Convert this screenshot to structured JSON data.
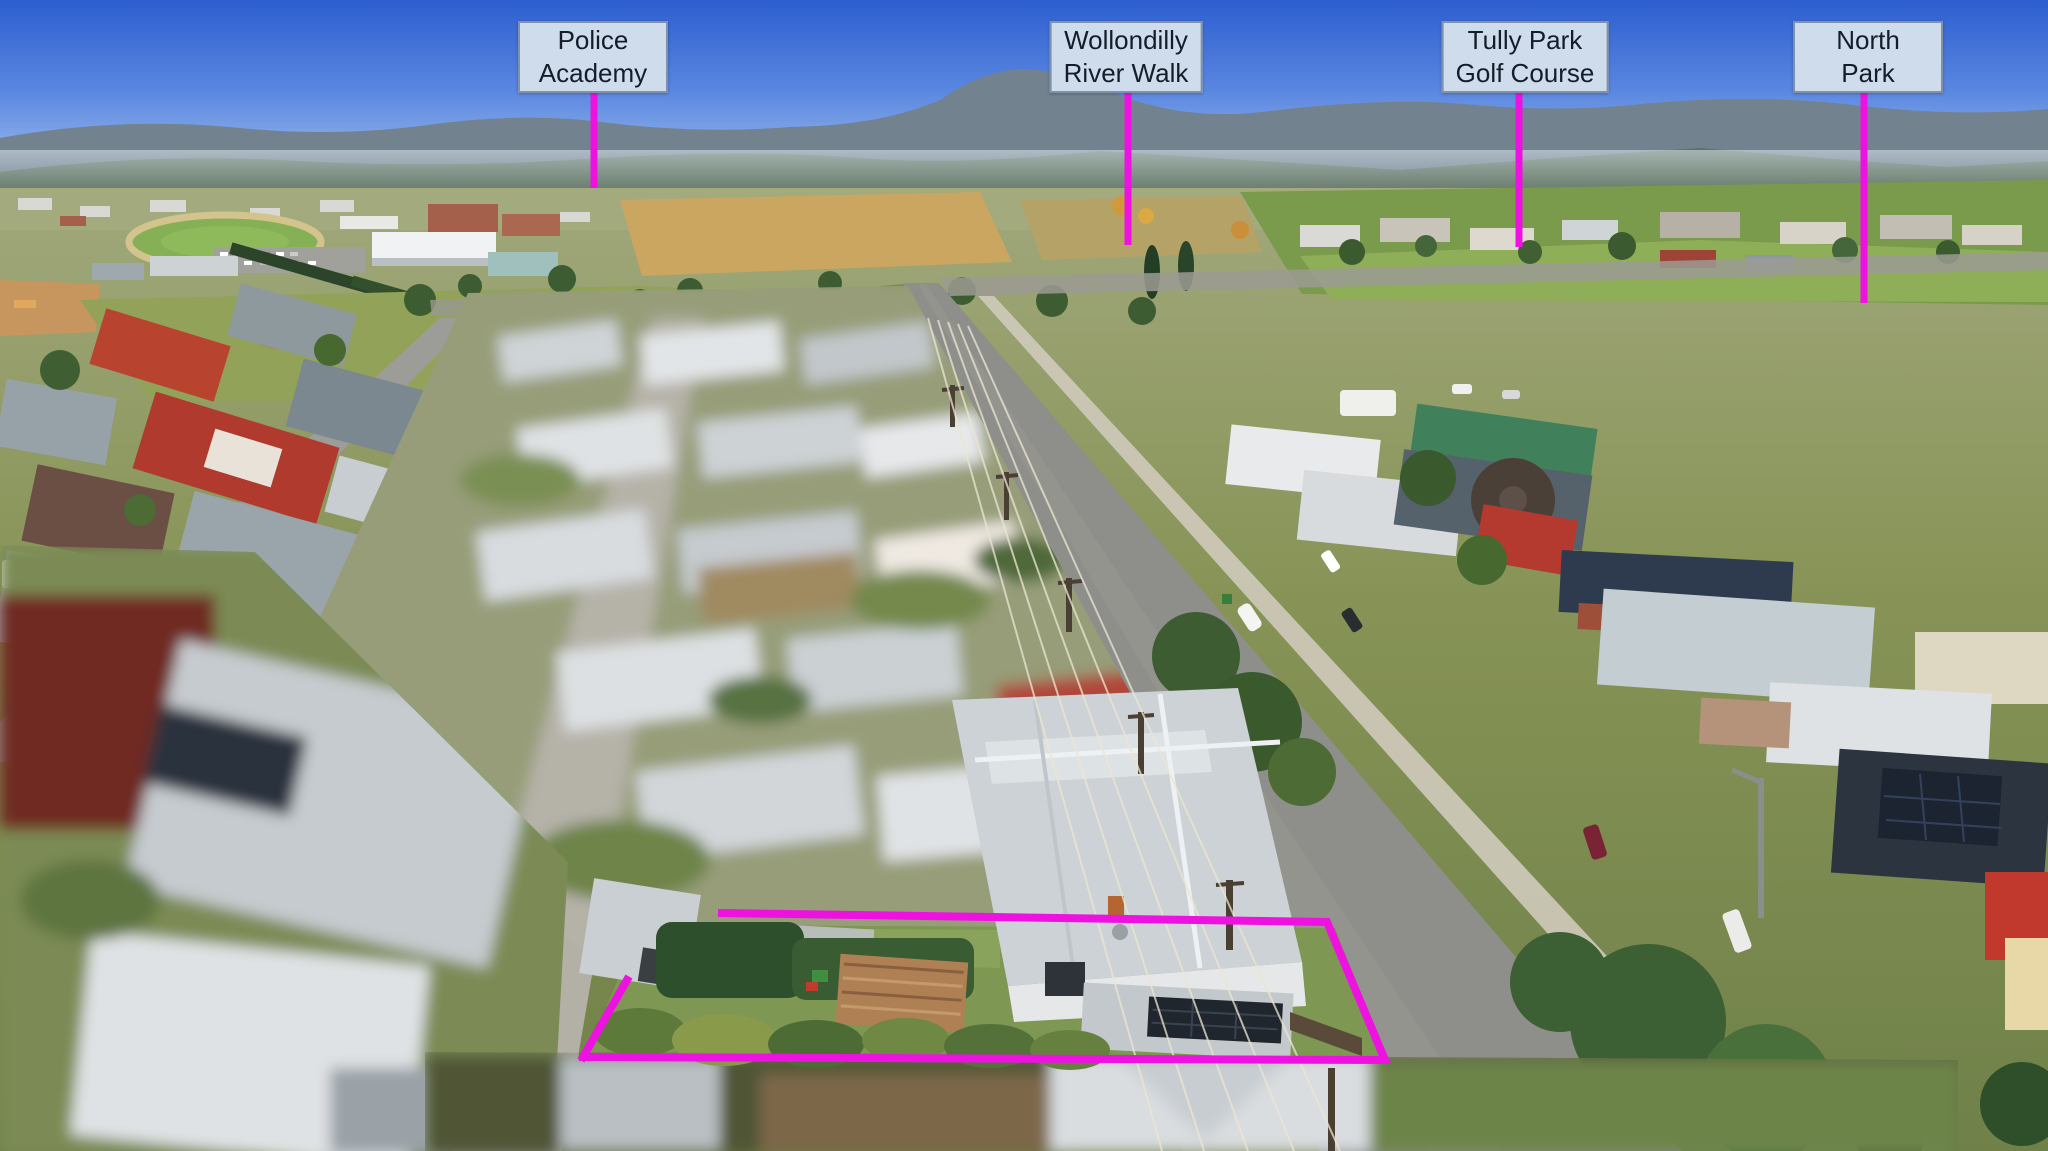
{
  "scene": {
    "type": "aerial-property-marketing-photo",
    "width_px": 2048,
    "height_px": 1151,
    "description": "Oblique drone photo of a country town suburb; subject property outlined, neighbouring properties blurred"
  },
  "annotations": {
    "accent_color": "#ee12e0",
    "label_bg_color": "#cfdcec",
    "label_border_color": "#8091ab",
    "label_text_color": "#151d2b",
    "landmarks": [
      {
        "name": "police-academy",
        "lines": [
          "Police",
          "Academy"
        ]
      },
      {
        "name": "wollondilly-river-walk",
        "lines": [
          "Wollondilly",
          "River Walk"
        ]
      },
      {
        "name": "tully-park-golf-course",
        "lines": [
          "Tully Park",
          "Golf Course"
        ]
      },
      {
        "name": "north-park",
        "lines": [
          "North",
          "Park"
        ]
      }
    ],
    "property_outline": {
      "color": "#ee12e0",
      "meaning": "boundary of advertised property"
    }
  }
}
